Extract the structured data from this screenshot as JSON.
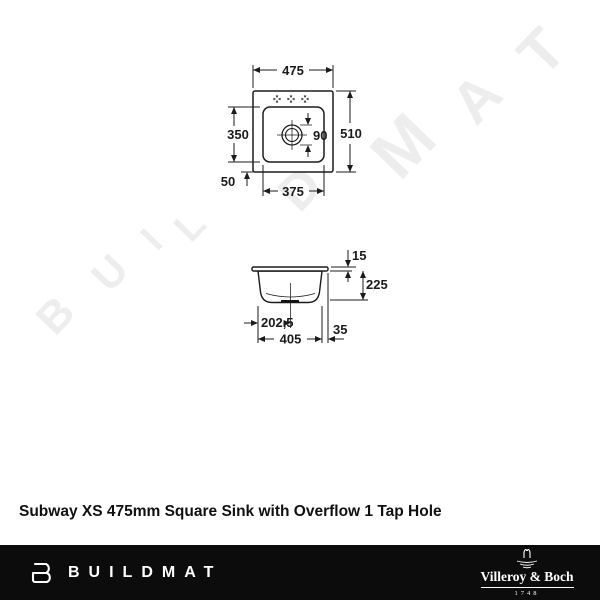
{
  "watermark": {
    "letters": [
      "B",
      "U",
      "I",
      "L",
      "D",
      "M",
      "A",
      "T"
    ]
  },
  "title": "Subway XS 475mm Square Sink with Overflow 1 Tap Hole",
  "top_view": {
    "dims": {
      "overall_width": "475",
      "overall_height": "510",
      "bowl_length": "350",
      "rear_offset": "50",
      "bowl_width": "375",
      "drain_diameter": "90"
    }
  },
  "side_view": {
    "dims": {
      "rim_height": "15",
      "bowl_depth": "225",
      "center_offset": "202,5",
      "bowl_width": "405",
      "edge_offset": "35"
    }
  },
  "footer": {
    "brand": "BUILDMAT",
    "vb_name": "Villeroy & Boch",
    "vb_year": "1748"
  },
  "colors": {
    "background": "#ffffff",
    "line": "#1b1b1b",
    "watermark": "#ededed",
    "footer_bg": "#0c0c0c",
    "footer_text": "#ffffff"
  }
}
